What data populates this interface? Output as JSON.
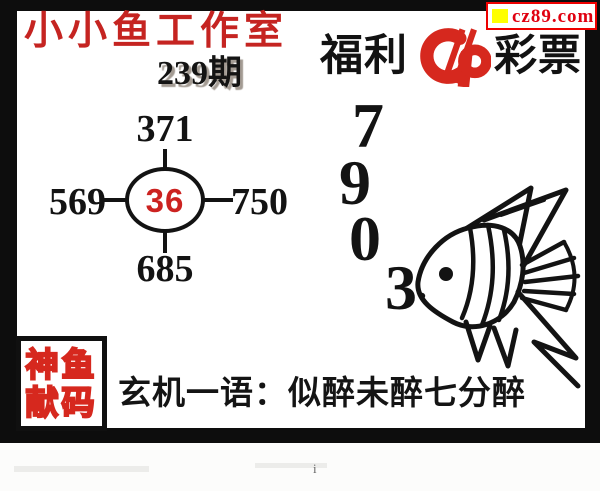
{
  "site_badge": {
    "text": "cz89.com"
  },
  "header": {
    "studio_title": "小小鱼工作室",
    "issue": "239期",
    "brand_prefix": "福利",
    "brand_suffix": "彩票"
  },
  "number_cross": {
    "top": "371",
    "left": "569",
    "right": "750",
    "bottom": "685",
    "center": "36"
  },
  "big_digits": [
    "7",
    "9",
    "0",
    "3"
  ],
  "seal": {
    "line1": "神鱼",
    "line2": "献码"
  },
  "phrase": "玄机一语：似醉未醉七分醉",
  "footer": {
    "mark": "i"
  },
  "colors": {
    "title_red": "#c52421",
    "center_red": "#cc2220",
    "logo_red": "#d6281e",
    "badge_red": "#e00010",
    "badge_yellow": "#ffff00",
    "ink": "#131313"
  }
}
